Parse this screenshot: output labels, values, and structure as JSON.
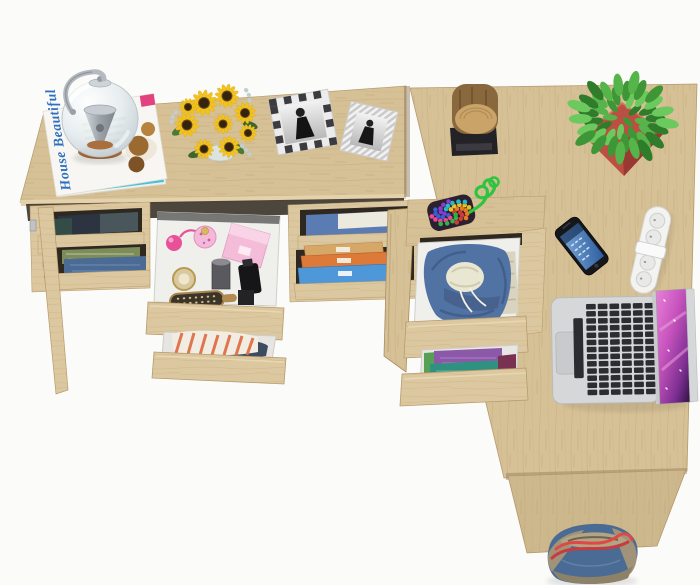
{
  "scene": {
    "label": "Top view of a light-oak L-shaped dressing table and desk with open drawers of clothes, cosmetics and accessories",
    "visible_text": {
      "magazine_title": "House Beautiful"
    },
    "palette": {
      "floor": "#fbfbfa",
      "wood": "#d6c096",
      "wood_front": "#dcc8a0",
      "wood_edge": "#b79b6c",
      "shadow_gap": "#3a3228",
      "drawer_interior": "#efefec",
      "magazine_title": "#2f6fc0",
      "sunflower": "#f2c21e",
      "sunflower_center": "#33230f",
      "leaf_green": "#4a7a38",
      "plant_greens": [
        "#3f9637",
        "#55b44a",
        "#2f7d2b",
        "#6cc95e"
      ],
      "pot_red": "#bc4f41",
      "log_brown": "#8a683e",
      "log_top": "#c9a368",
      "base_black": "#232327",
      "cord_green": "#2fc43f",
      "bead_colors": [
        "#d23b3b",
        "#3b5fd2",
        "#e8c228",
        "#35b04a",
        "#8a3bd2",
        "#e87a28",
        "#e84898",
        "#28b8c8"
      ],
      "phone_screen_blue": "#4678b2",
      "power_strip_white": "#f3f3f2",
      "laptop_silver": "#d5d7d9",
      "key_black": "#222428",
      "screen_magenta": "#c653bd",
      "hoodie_blue": "#5173a3",
      "hoodie_lining": "#e9e6d2",
      "cloth_purple": "#8b59a8",
      "cloth_teal": "#2f9180",
      "cloth_green": "#55a055",
      "cloth_maroon": "#7a3050",
      "stripe_orange": "#dd6a3d",
      "denim": "#47618a",
      "box_tan": "#d6a766",
      "box_orange": "#dd7a3a",
      "box_blue": "#4e97d8",
      "bag_blue": "#4a6b93",
      "bag_khaki": "#b3a483",
      "strap_red": "#e04747",
      "perfume_pink": "#e85098",
      "box_pink": "#f4bcd8",
      "frame_dark": "#3c3c40"
    },
    "objects": [
      {
        "name": "glass-kettle"
      },
      {
        "name": "magazine-stack"
      },
      {
        "name": "sunflower-bouquet"
      },
      {
        "name": "photo-frame-checkered"
      },
      {
        "name": "photo-frame-striped"
      },
      {
        "name": "log-decoration"
      },
      {
        "name": "potted-plant"
      },
      {
        "name": "bead-keychain"
      },
      {
        "name": "smartphone"
      },
      {
        "name": "power-strip"
      },
      {
        "name": "laptop"
      },
      {
        "name": "tote-bag"
      },
      {
        "name": "cosmetics-drawer"
      },
      {
        "name": "striped-clothes-drawer"
      },
      {
        "name": "hoodie-drawer"
      },
      {
        "name": "folded-clothes-drawer"
      },
      {
        "name": "storage-boxes"
      },
      {
        "name": "shelf-clothes"
      }
    ]
  }
}
